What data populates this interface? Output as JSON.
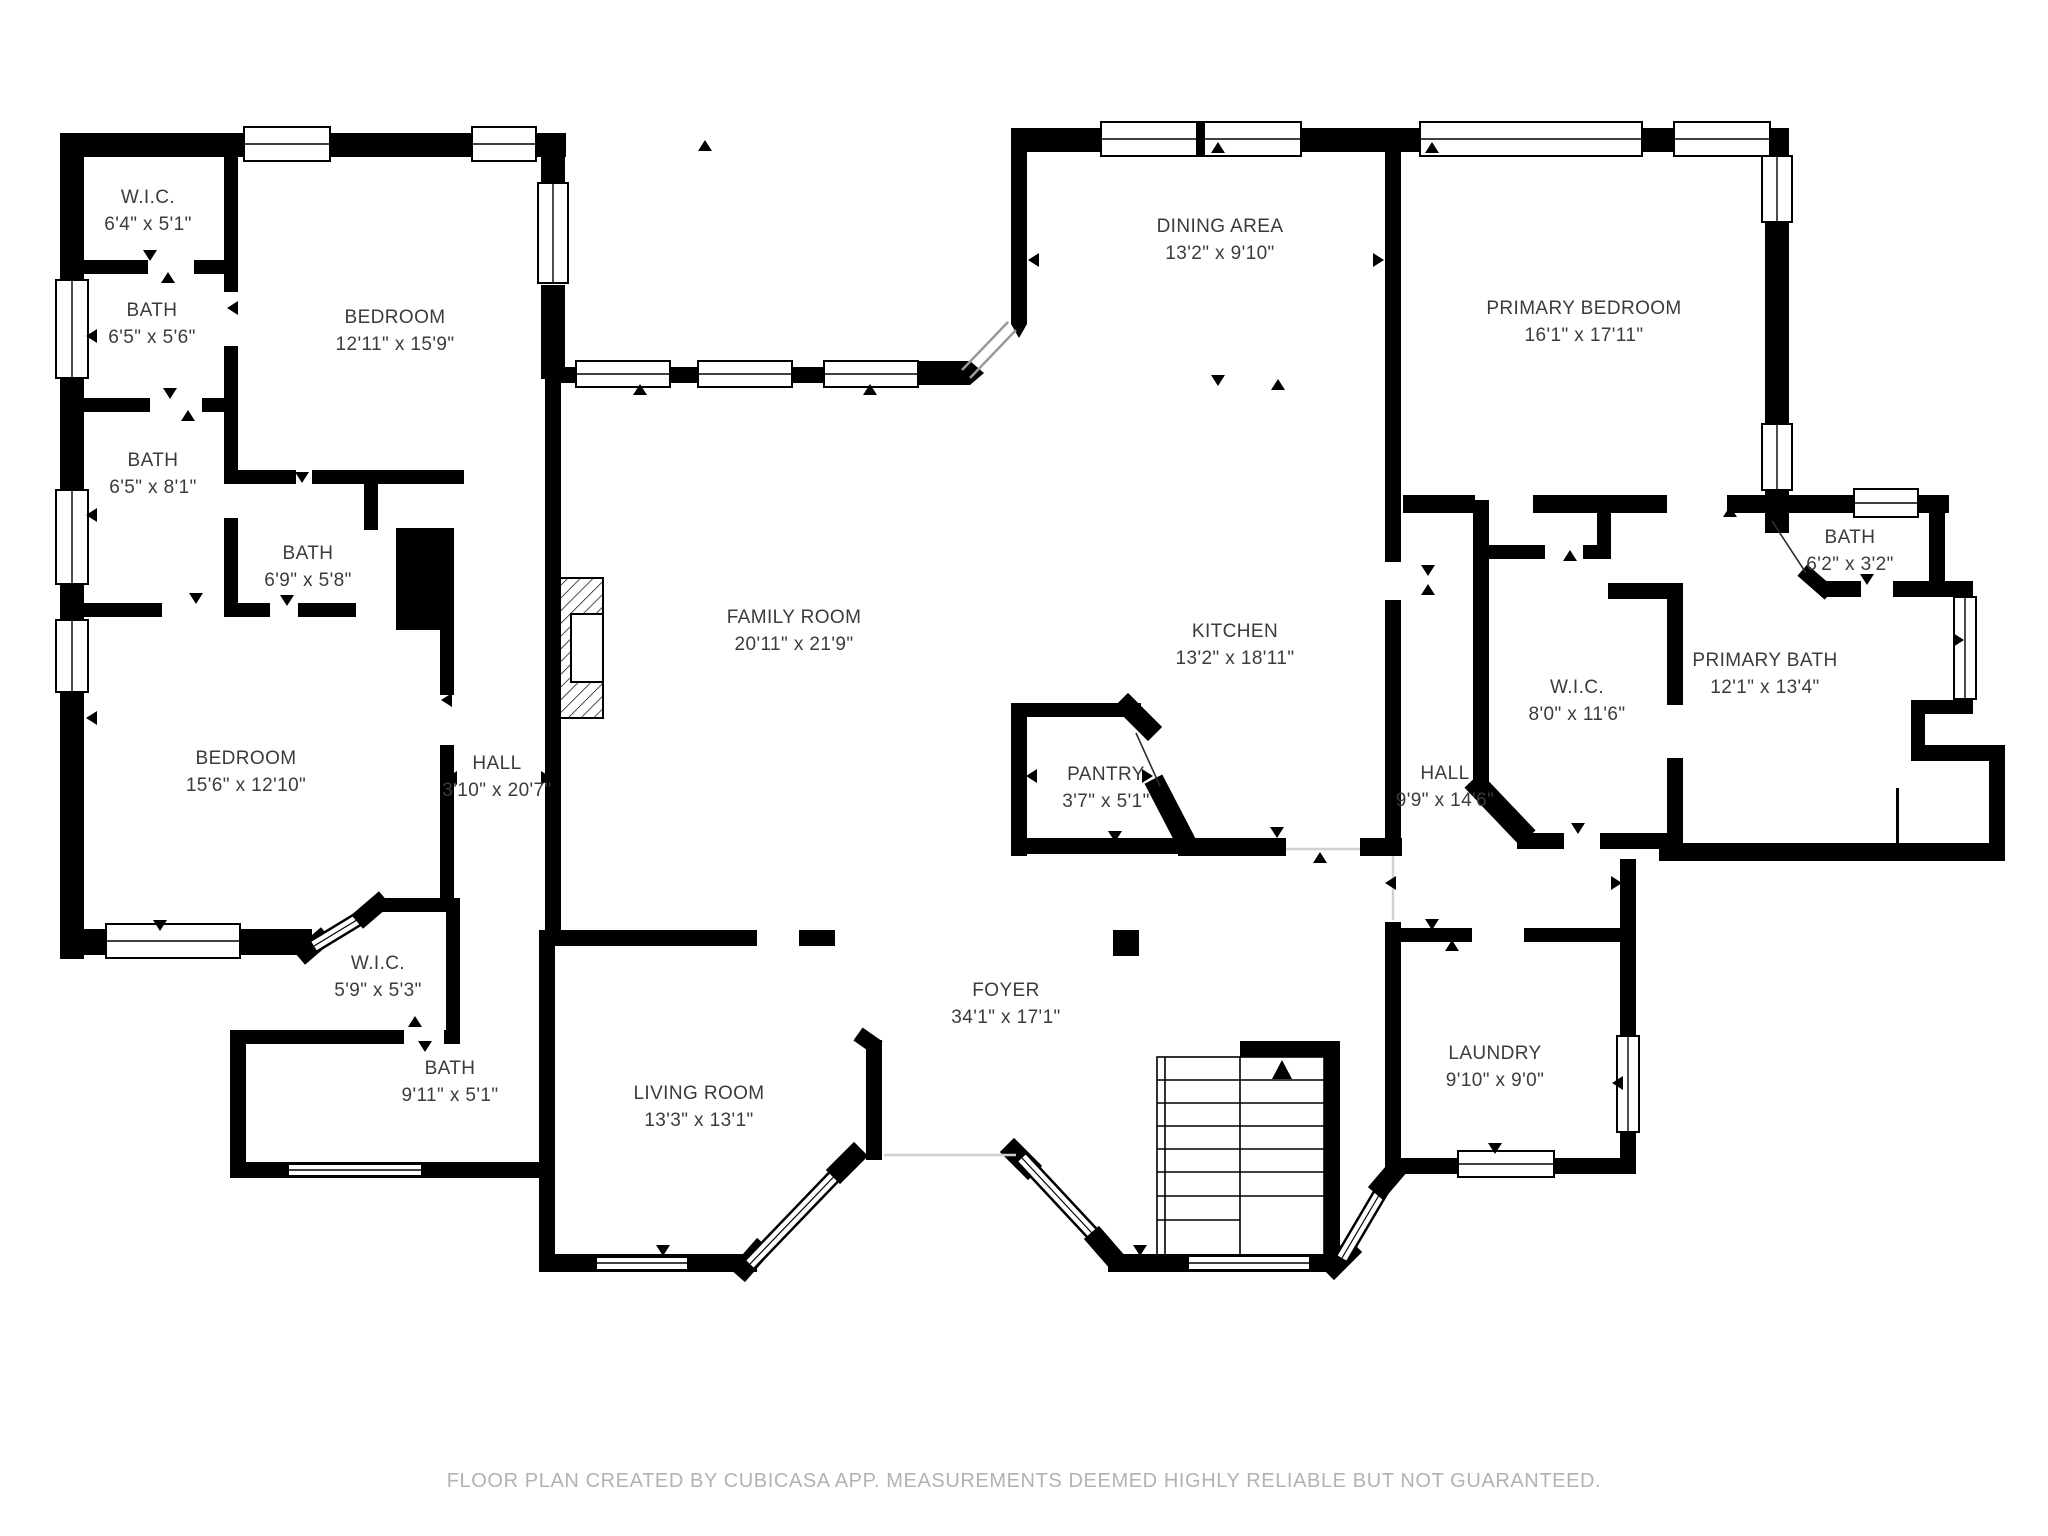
{
  "colors": {
    "background": "#ffffff",
    "wall": "#000000",
    "label_text": "#3b3b3b",
    "footer_text": "#b2b2b2"
  },
  "annotations": {
    "stairs_direction_arrow": "up"
  },
  "rooms": [
    {
      "id": "wic-top-left",
      "name": "W.I.C.",
      "dims": "6'4\" x 5'1\""
    },
    {
      "id": "bath-top-left",
      "name": "BATH",
      "dims": "6'5\" x 5'6\""
    },
    {
      "id": "bath-mid-left",
      "name": "BATH",
      "dims": "6'5\" x 8'1\""
    },
    {
      "id": "bath-center",
      "name": "BATH",
      "dims": "6'9\" x 5'8\""
    },
    {
      "id": "bedroom-top",
      "name": "BEDROOM",
      "dims": "12'11\" x 15'9\""
    },
    {
      "id": "bedroom-left",
      "name": "BEDROOM",
      "dims": "15'6\" x 12'10\""
    },
    {
      "id": "hall-left",
      "name": "HALL",
      "dims": "3'10\" x 20'7\""
    },
    {
      "id": "family-room",
      "name": "FAMILY ROOM",
      "dims": "20'11\" x 21'9\""
    },
    {
      "id": "dining-area",
      "name": "DINING AREA",
      "dims": "13'2\" x 9'10\""
    },
    {
      "id": "kitchen",
      "name": "KITCHEN",
      "dims": "13'2\" x 18'11\""
    },
    {
      "id": "pantry",
      "name": "PANTRY",
      "dims": "3'7\" x 5'1\""
    },
    {
      "id": "primary-bedroom",
      "name": "PRIMARY BEDROOM",
      "dims": "16'1\" x 17'11\""
    },
    {
      "id": "bath-top-right",
      "name": "BATH",
      "dims": "6'2\" x 3'2\""
    },
    {
      "id": "primary-bath",
      "name": "PRIMARY BATH",
      "dims": "12'1\" x 13'4\""
    },
    {
      "id": "wic-right",
      "name": "W.I.C.",
      "dims": "8'0\" x 11'6\""
    },
    {
      "id": "hall-right",
      "name": "HALL",
      "dims": "9'9\" x 14'6\""
    },
    {
      "id": "wic-bottom-left",
      "name": "W.I.C.",
      "dims": "5'9\" x 5'3\""
    },
    {
      "id": "bath-bottom-left",
      "name": "BATH",
      "dims": "9'11\" x 5'1\""
    },
    {
      "id": "living-room",
      "name": "LIVING ROOM",
      "dims": "13'3\" x 13'1\""
    },
    {
      "id": "foyer",
      "name": "FOYER",
      "dims": "34'1\" x 17'1\""
    },
    {
      "id": "laundry",
      "name": "LAUNDRY",
      "dims": "9'10\" x 9'0\""
    }
  ],
  "footer": {
    "note": "FLOOR PLAN CREATED BY CUBICASA APP. MEASUREMENTS DEEMED HIGHLY RELIABLE BUT NOT GUARANTEED."
  }
}
